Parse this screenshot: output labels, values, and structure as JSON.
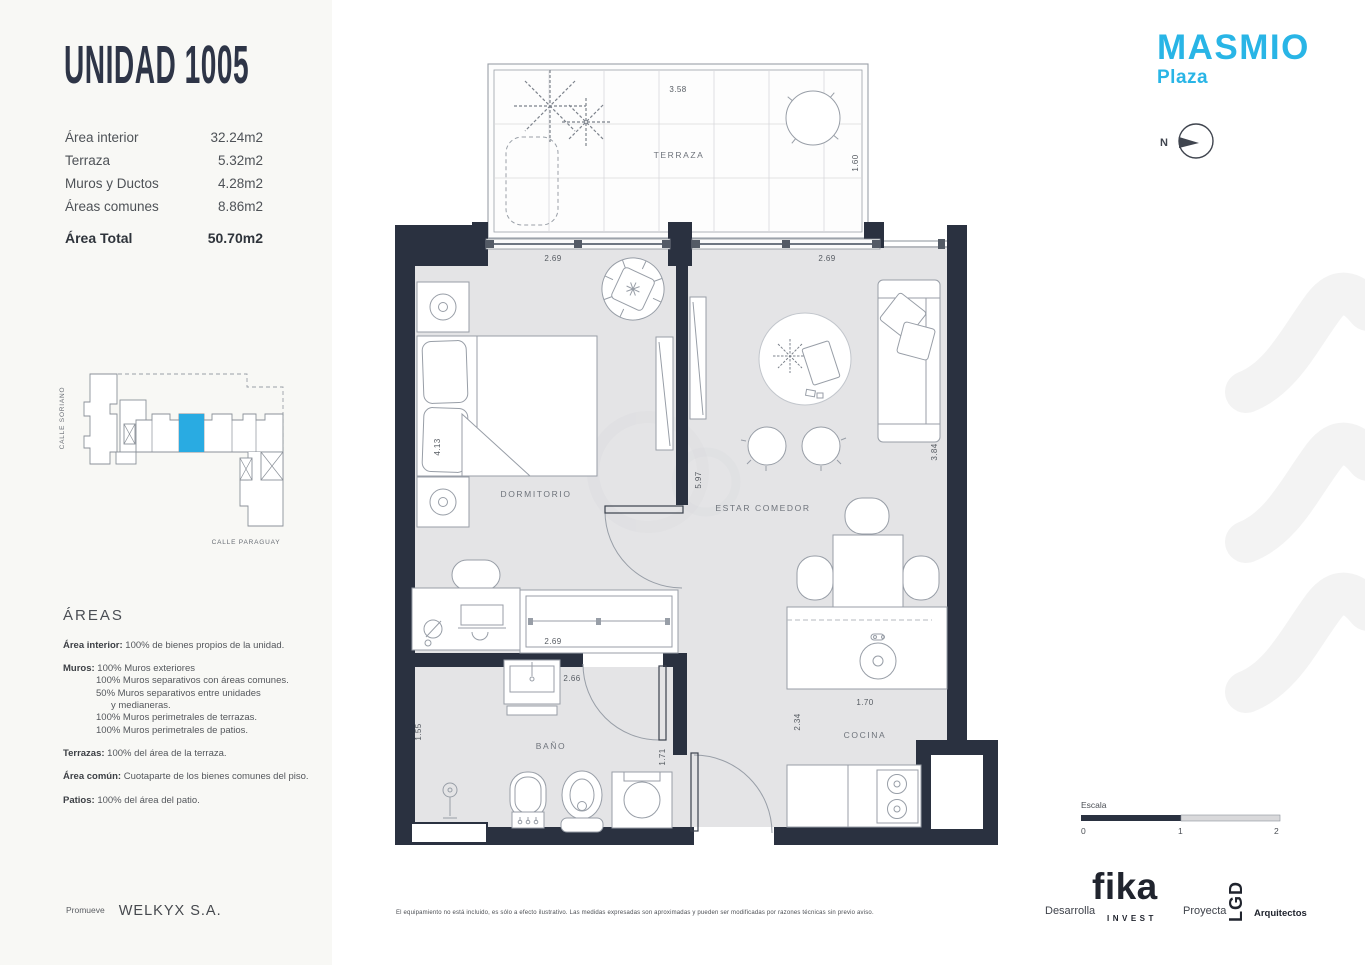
{
  "colors": {
    "accent": "#29b5e6",
    "wall": "#2a3140",
    "unit_highlight": "#29abe2"
  },
  "unit": {
    "title": "UNIDAD 1005"
  },
  "areas_table": {
    "rows": [
      {
        "label": "Área interior",
        "value": "32.24m2"
      },
      {
        "label": "Terraza",
        "value": "5.32m2"
      },
      {
        "label": "Muros y Ductos",
        "value": "4.28m2"
      },
      {
        "label": "Áreas comunes",
        "value": "8.86m2"
      }
    ],
    "total": {
      "label": "Área Total",
      "value": "50.70m2"
    }
  },
  "site_map": {
    "street_vertical": "CALLE SORIANO",
    "street_bottom": "CALLE PARAGUAY"
  },
  "areas_notes": {
    "heading": "ÁREAS",
    "items": [
      {
        "lead": "Área interior:",
        "text": " 100% de bienes propios de la unidad."
      },
      {
        "lead": "Muros:",
        "text": " 100% Muros exteriores",
        "lines": [
          "100% Muros separativos con áreas comunes.",
          "50%  Muros separativos entre unidades",
          "y medianeras.",
          "100% Muros perimetrales de terrazas.",
          "100% Muros perimetrales de patios."
        ]
      },
      {
        "lead": "Terrazas:",
        "text": " 100% del área de la terraza."
      },
      {
        "lead": "Área común:",
        "text": " Cuotaparte de los bienes comunes del piso."
      },
      {
        "lead": "Patios:",
        "text": " 100% del área del patio."
      }
    ]
  },
  "promoter": {
    "label": "Promueve",
    "name": "WELKYX S.A."
  },
  "brand": {
    "name": "MASMIO",
    "sub": "Plaza"
  },
  "compass": {
    "label": "N"
  },
  "plan": {
    "labels": {
      "terraza": "TERRAZA",
      "dormitorio": "DORMITORIO",
      "estar": "ESTAR COMEDOR",
      "bano": "BAÑO",
      "cocina": "COCINA"
    },
    "dims": {
      "terraza_width": "3.58",
      "terraza_depth": "1.60",
      "dorm_width": "2.69",
      "estar_width": "2.69",
      "dorm_length": "4.13",
      "living_length": "5.97",
      "estar_depth": "3.84",
      "closet_width": "2.69",
      "bath_width": "2.66",
      "shower_width": "1.55",
      "hall_width": "1.71",
      "kitchen_width": "1.70",
      "kitchen_depth": "2.34"
    }
  },
  "scale_bar": {
    "label": "Escala",
    "ticks": [
      "0",
      "1",
      "2"
    ]
  },
  "disclaimer": "El equipamiento no está incluido, es sólo a efecto ilustrativo. Las medidas expresadas son aproximadas y pueden ser modificadas por razones técnicas sin previo aviso.",
  "credits": {
    "develop_label": "Desarrolla",
    "developer": "fika",
    "developer_sub": "INVEST",
    "project_label": "Proyecta",
    "architect": "LGD",
    "architect_sub": "Arquitectos"
  }
}
